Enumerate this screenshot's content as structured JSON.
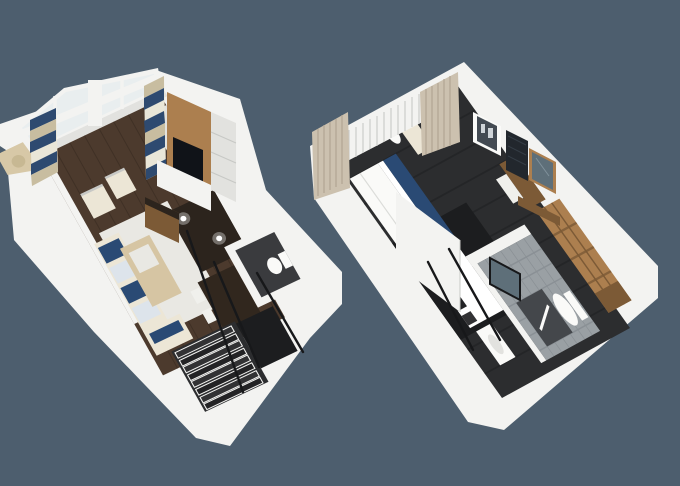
{
  "scene": {
    "description": "3D cutaway floor plans of a two-level loft suite shown side by side on a slate background",
    "levels": [
      {
        "id": "lower-level",
        "rooms": [
          "balcony",
          "living-room",
          "dining-area",
          "powder-room",
          "staircase"
        ],
        "furniture": [
          "double-height-window-wall",
          "patterned-curtains",
          "sofa-with-navy-cushions",
          "armchairs",
          "coffee-table",
          "area-rug",
          "tv-media-wall",
          "media-console",
          "bar-counter",
          "dining-table",
          "dining-chairs",
          "toilet",
          "stairs",
          "stair-railing"
        ]
      },
      {
        "id": "upper-level",
        "rooms": [
          "bedroom",
          "bathroom",
          "stair-landing"
        ],
        "furniture": [
          "bed",
          "pillows",
          "navy-bed-runner",
          "partition-wall",
          "armchair",
          "round-side-table",
          "beige-curtains",
          "shutter-window-wall",
          "wall-art",
          "dark-wall-panel",
          "framed-mirror",
          "vanity-desk",
          "desk-chair",
          "wardrobe",
          "toilet",
          "sink",
          "shower-mat",
          "bathroom-mirror",
          "stair-railing"
        ]
      }
    ]
  },
  "colors": {
    "bg": "#4d5e6e",
    "wall": "#f3f3f1",
    "wall-shade": "#e2e2df",
    "wall-dark": "#c7c8c5",
    "floor-wood": "#4c3a2d",
    "floor-wood-line": "#35281f",
    "balcony": "#d7c8a7",
    "wicker": "#c7b893",
    "glass": "#dfe9ee",
    "rug": "#e9e8e3",
    "sofa": "#ece6d6",
    "cushion-navy": "#2a4a74",
    "cushion-light": "#dde4eb",
    "table-light": "#d6c5a3",
    "table-dark": "#31271e",
    "chair-white": "#f0f0ec",
    "counter-dark": "#2c241d",
    "carpet": "#2c2d2f",
    "carpet-dark": "#1c1d1f",
    "tile": "#9aa0a4",
    "tile-grid": "#83898e",
    "tile-dark": "#3a3b3e",
    "shower": "#44474b",
    "fixture": "#fafaf8",
    "white-bright": "#ffffff",
    "wood": "#ac7f4f",
    "wood-dark": "#7c5a36",
    "tv": "#101318",
    "curtain-beige": "#ccc1af",
    "curtain-fold": "#b2a692",
    "curtain-navy": "#2e4a70",
    "curtain-tan": "#c8bda0",
    "curtain-white": "#e9e6d8",
    "railing": "#17181a",
    "stair-step": "#323234",
    "stair-step-dark": "#232325",
    "art-inner": "#434a52",
    "art-blob": "#cfd4d8",
    "panel-dark": "#22272d",
    "panel-hatch": "#39424b",
    "mirror-glass": "#5e6f79",
    "mirror-glint": "#8fa0aa"
  }
}
